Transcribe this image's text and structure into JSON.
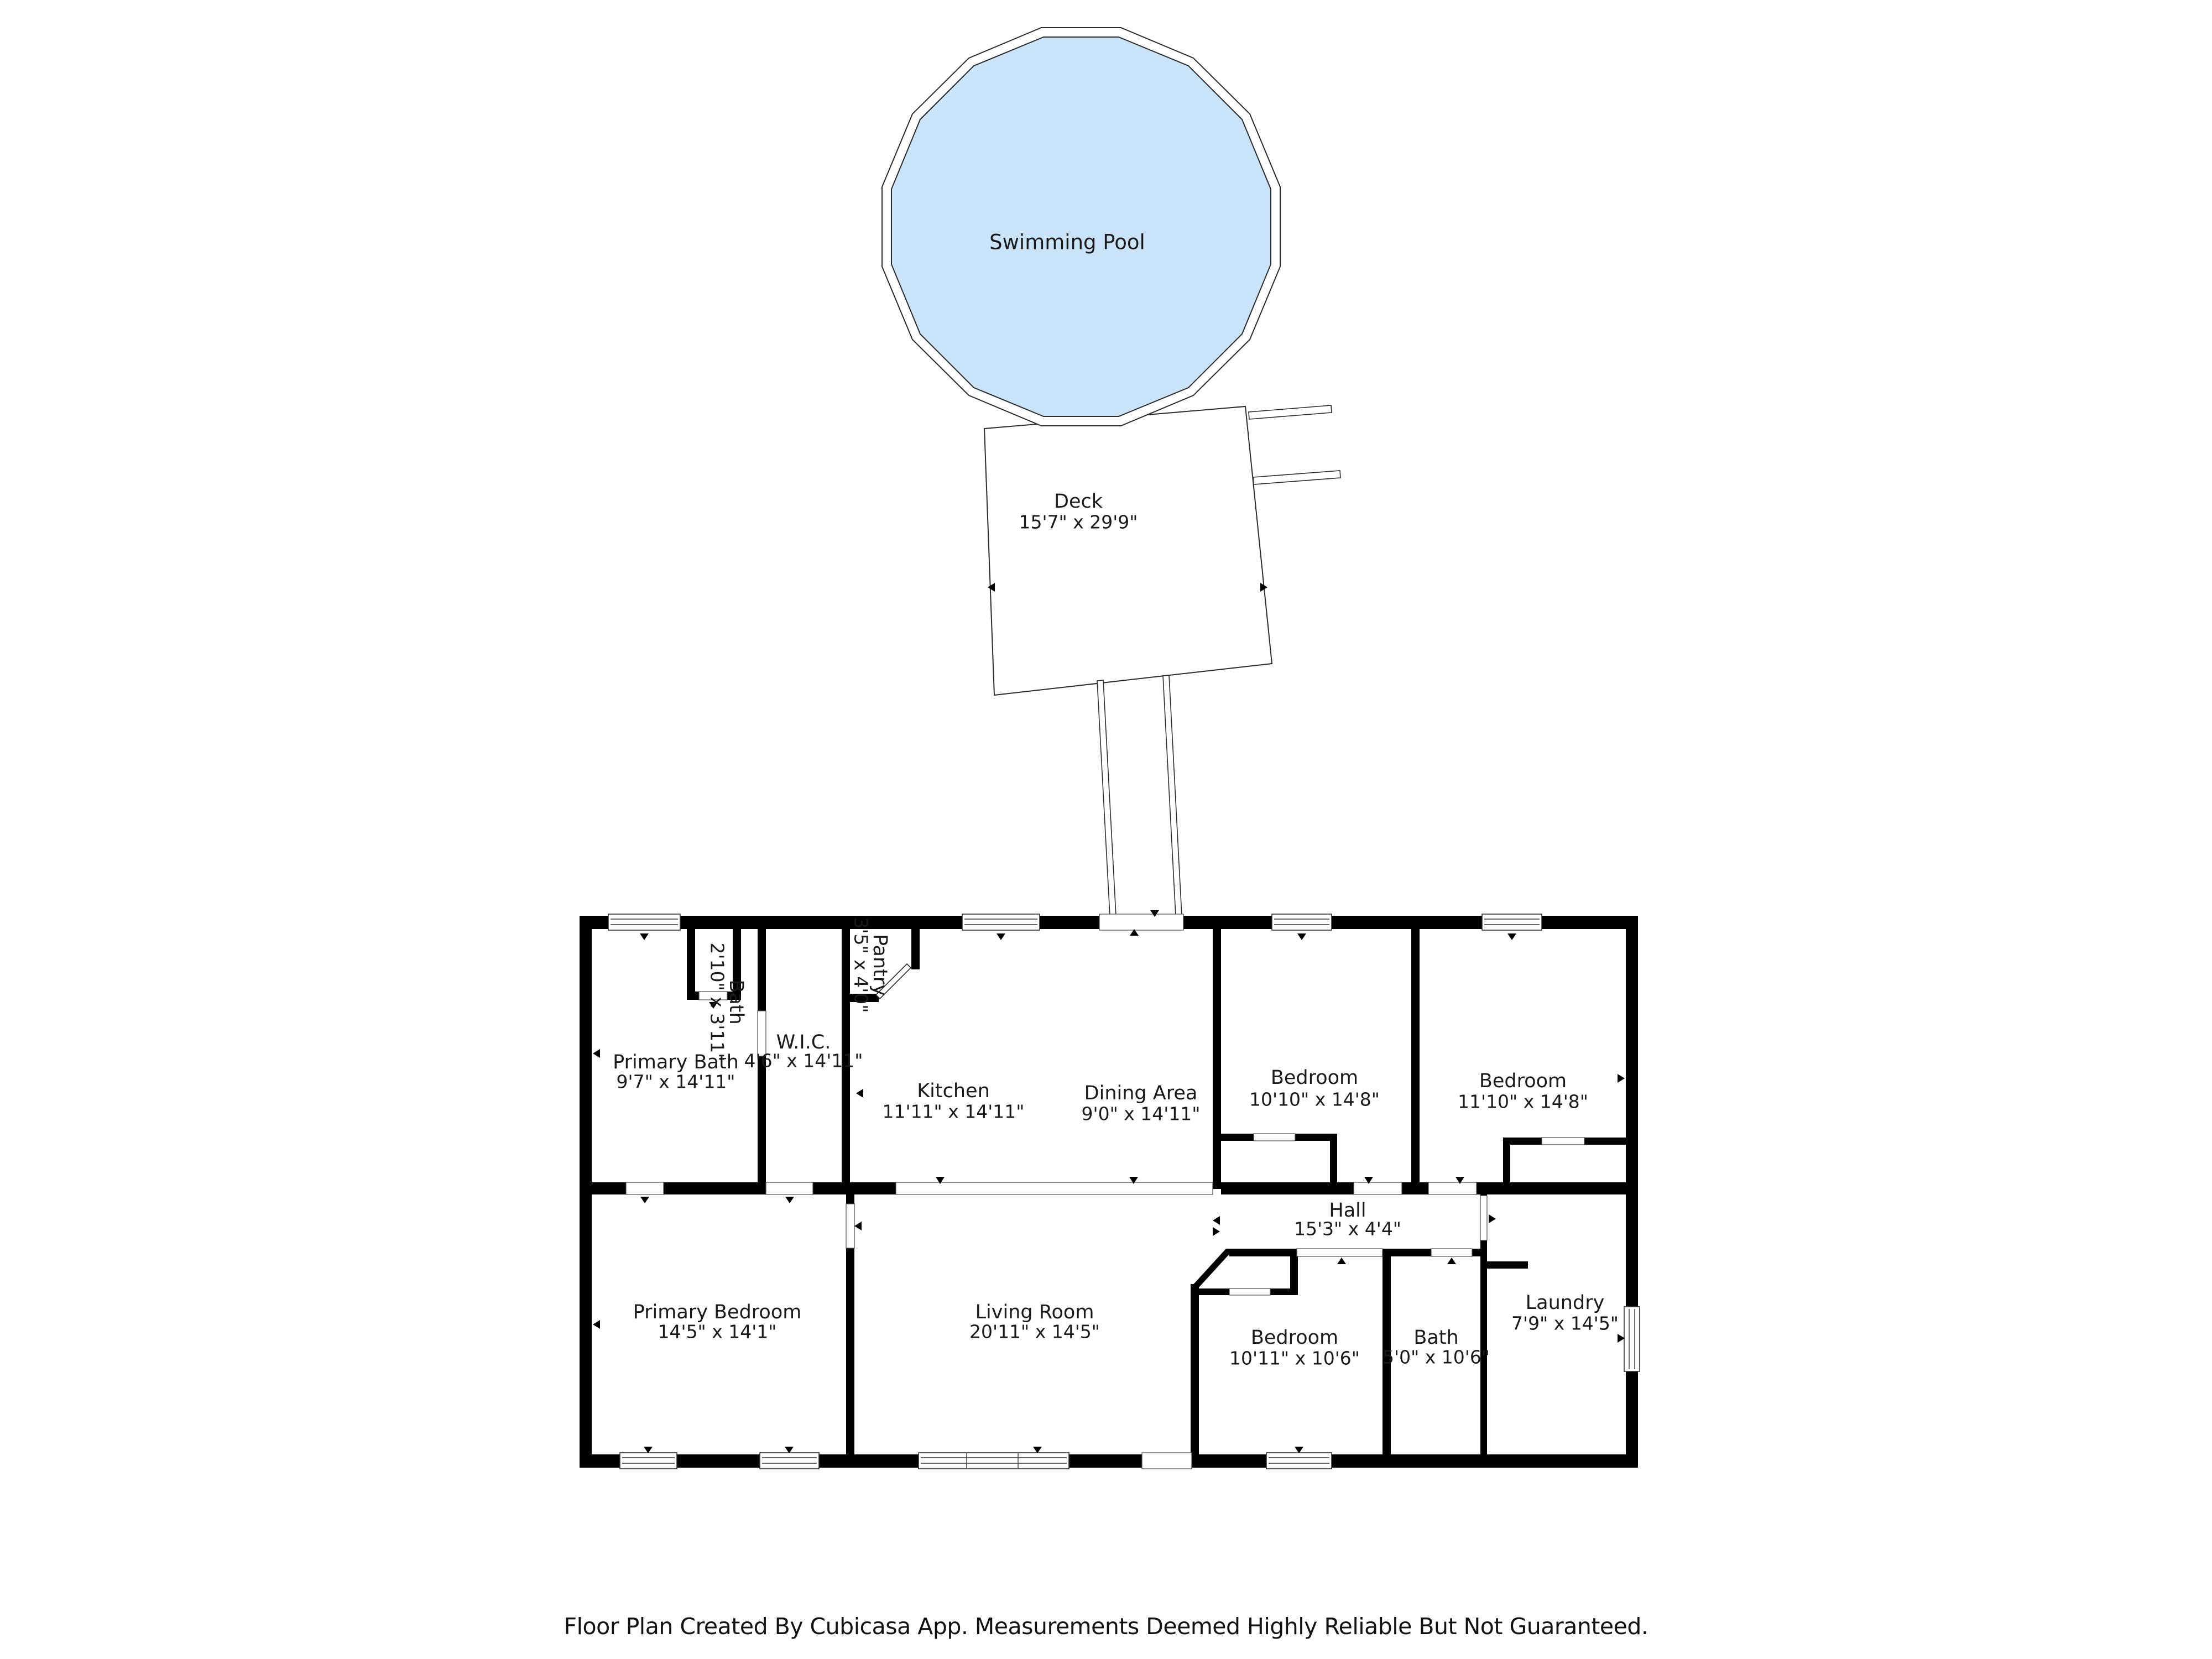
{
  "pool": {
    "label": "Swimming Pool"
  },
  "deck": {
    "name": "Deck",
    "dims": "15'7\" x 29'9\""
  },
  "rooms": {
    "primary_bath": {
      "name": "Primary Bath",
      "dims": "9'7\" x 14'11\""
    },
    "bath_small": {
      "name": "Bath",
      "dims": "2'10\" x 3'11\""
    },
    "wic": {
      "name": "W.I.C.",
      "dims": "4'6\" x 14'11\""
    },
    "pantry": {
      "name": "Pantry",
      "dims": "3'5\" x 4'0\""
    },
    "kitchen": {
      "name": "Kitchen",
      "dims": "11'11\" x 14'11\""
    },
    "dining": {
      "name": "Dining Area",
      "dims": "9'0\" x 14'11\""
    },
    "bedroom_left": {
      "name": "Bedroom",
      "dims": "10'10\" x 14'8\""
    },
    "bedroom_right": {
      "name": "Bedroom",
      "dims": "11'10\" x 14'8\""
    },
    "hall": {
      "name": "Hall",
      "dims": "15'3\" x 4'4\""
    },
    "primary_bedroom": {
      "name": "Primary Bedroom",
      "dims": "14'5\" x 14'1\""
    },
    "living_room": {
      "name": "Living Room",
      "dims": "20'11\" x 14'5\""
    },
    "bedroom_bottom": {
      "name": "Bedroom",
      "dims": "10'11\" x 10'6\""
    },
    "bath2": {
      "name": "Bath",
      "dims": "5'0\" x 10'6\""
    },
    "laundry": {
      "name": "Laundry",
      "dims": "7'9\" x 14'5\""
    }
  },
  "footer": {
    "text": "Floor Plan Created By Cubicasa App. Measurements Deemed Highly Reliable But Not Guaranteed."
  },
  "colors": {
    "pool_fill": "#c9e4f9",
    "wall": "#000000",
    "background": "#ffffff"
  }
}
